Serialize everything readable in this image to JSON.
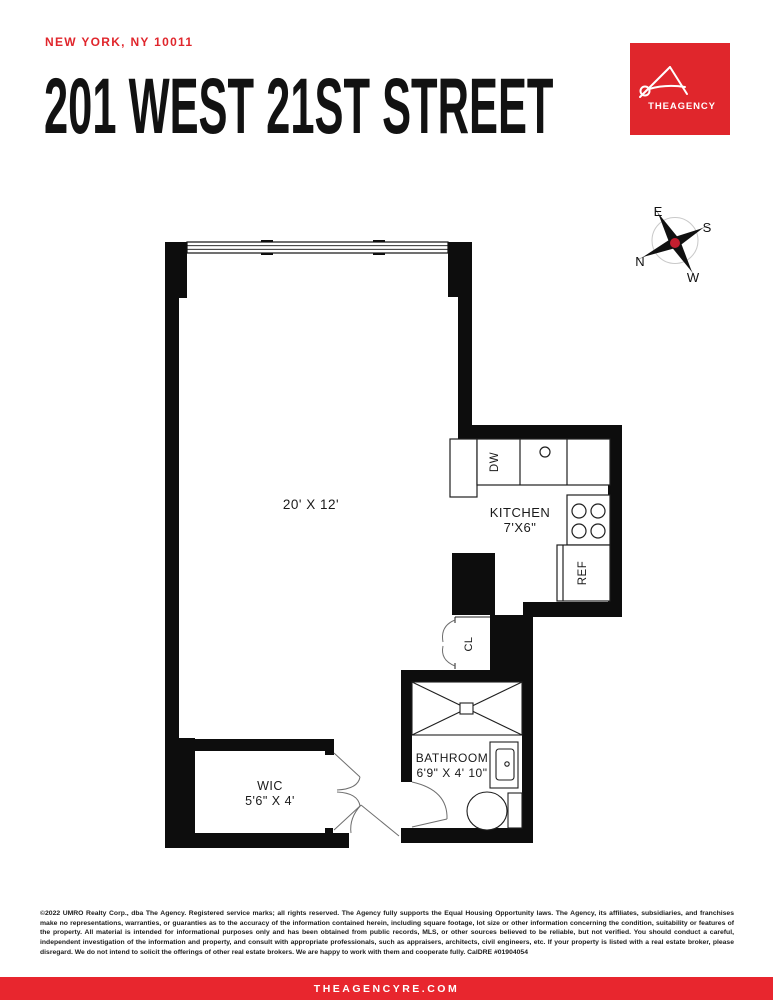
{
  "header": {
    "location": "NEW YORK, NY 10011",
    "title": "201 WEST 21ST STREET"
  },
  "logo": {
    "brand": "THEAGENCY",
    "color": "#e0262c"
  },
  "compass": {
    "e": "E",
    "s": "S",
    "n": "N",
    "w": "W"
  },
  "floorplan": {
    "main_room": {
      "dims": "20' X 12'"
    },
    "kitchen": {
      "name": "KITCHEN",
      "dims": "7'X6\""
    },
    "bathroom": {
      "name": "BATHROOM",
      "dims": "6'9\" X 4' 10\""
    },
    "wic": {
      "name": "WIC",
      "dims": "5'6\" X 4'"
    },
    "closet": {
      "label": "CL"
    },
    "appliances": {
      "dishwasher": "DW",
      "refrigerator": "REF"
    }
  },
  "disclaimer": {
    "text": "©2022 UMRO Realty Corp., dba The Agency. Registered service marks; all rights reserved. The Agency fully supports the Equal Housing Opportunity laws. The Agency, its affiliates, subsidiaries, and franchises make no representations, warranties, or guaranties as to the accuracy of the information contained herein, including square footage, lot size or other information concerning the condition, suitability or features of the property. All material is intended for informational purposes only and has been obtained from public records, MLS, or other sources believed to be reliable, but not verified. You should conduct a careful, independent investigation of the information and property, and consult with appropriate professionals, such as appraisers, architects, civil engineers, etc. If your property is listed with a real estate broker, please disregard. We do not intend to solicit the offerings of other real estate brokers. We are happy to work with them and cooperate fully. CalDRE #01904054"
  },
  "footer": {
    "website": "THEAGENCYRE.COM"
  }
}
